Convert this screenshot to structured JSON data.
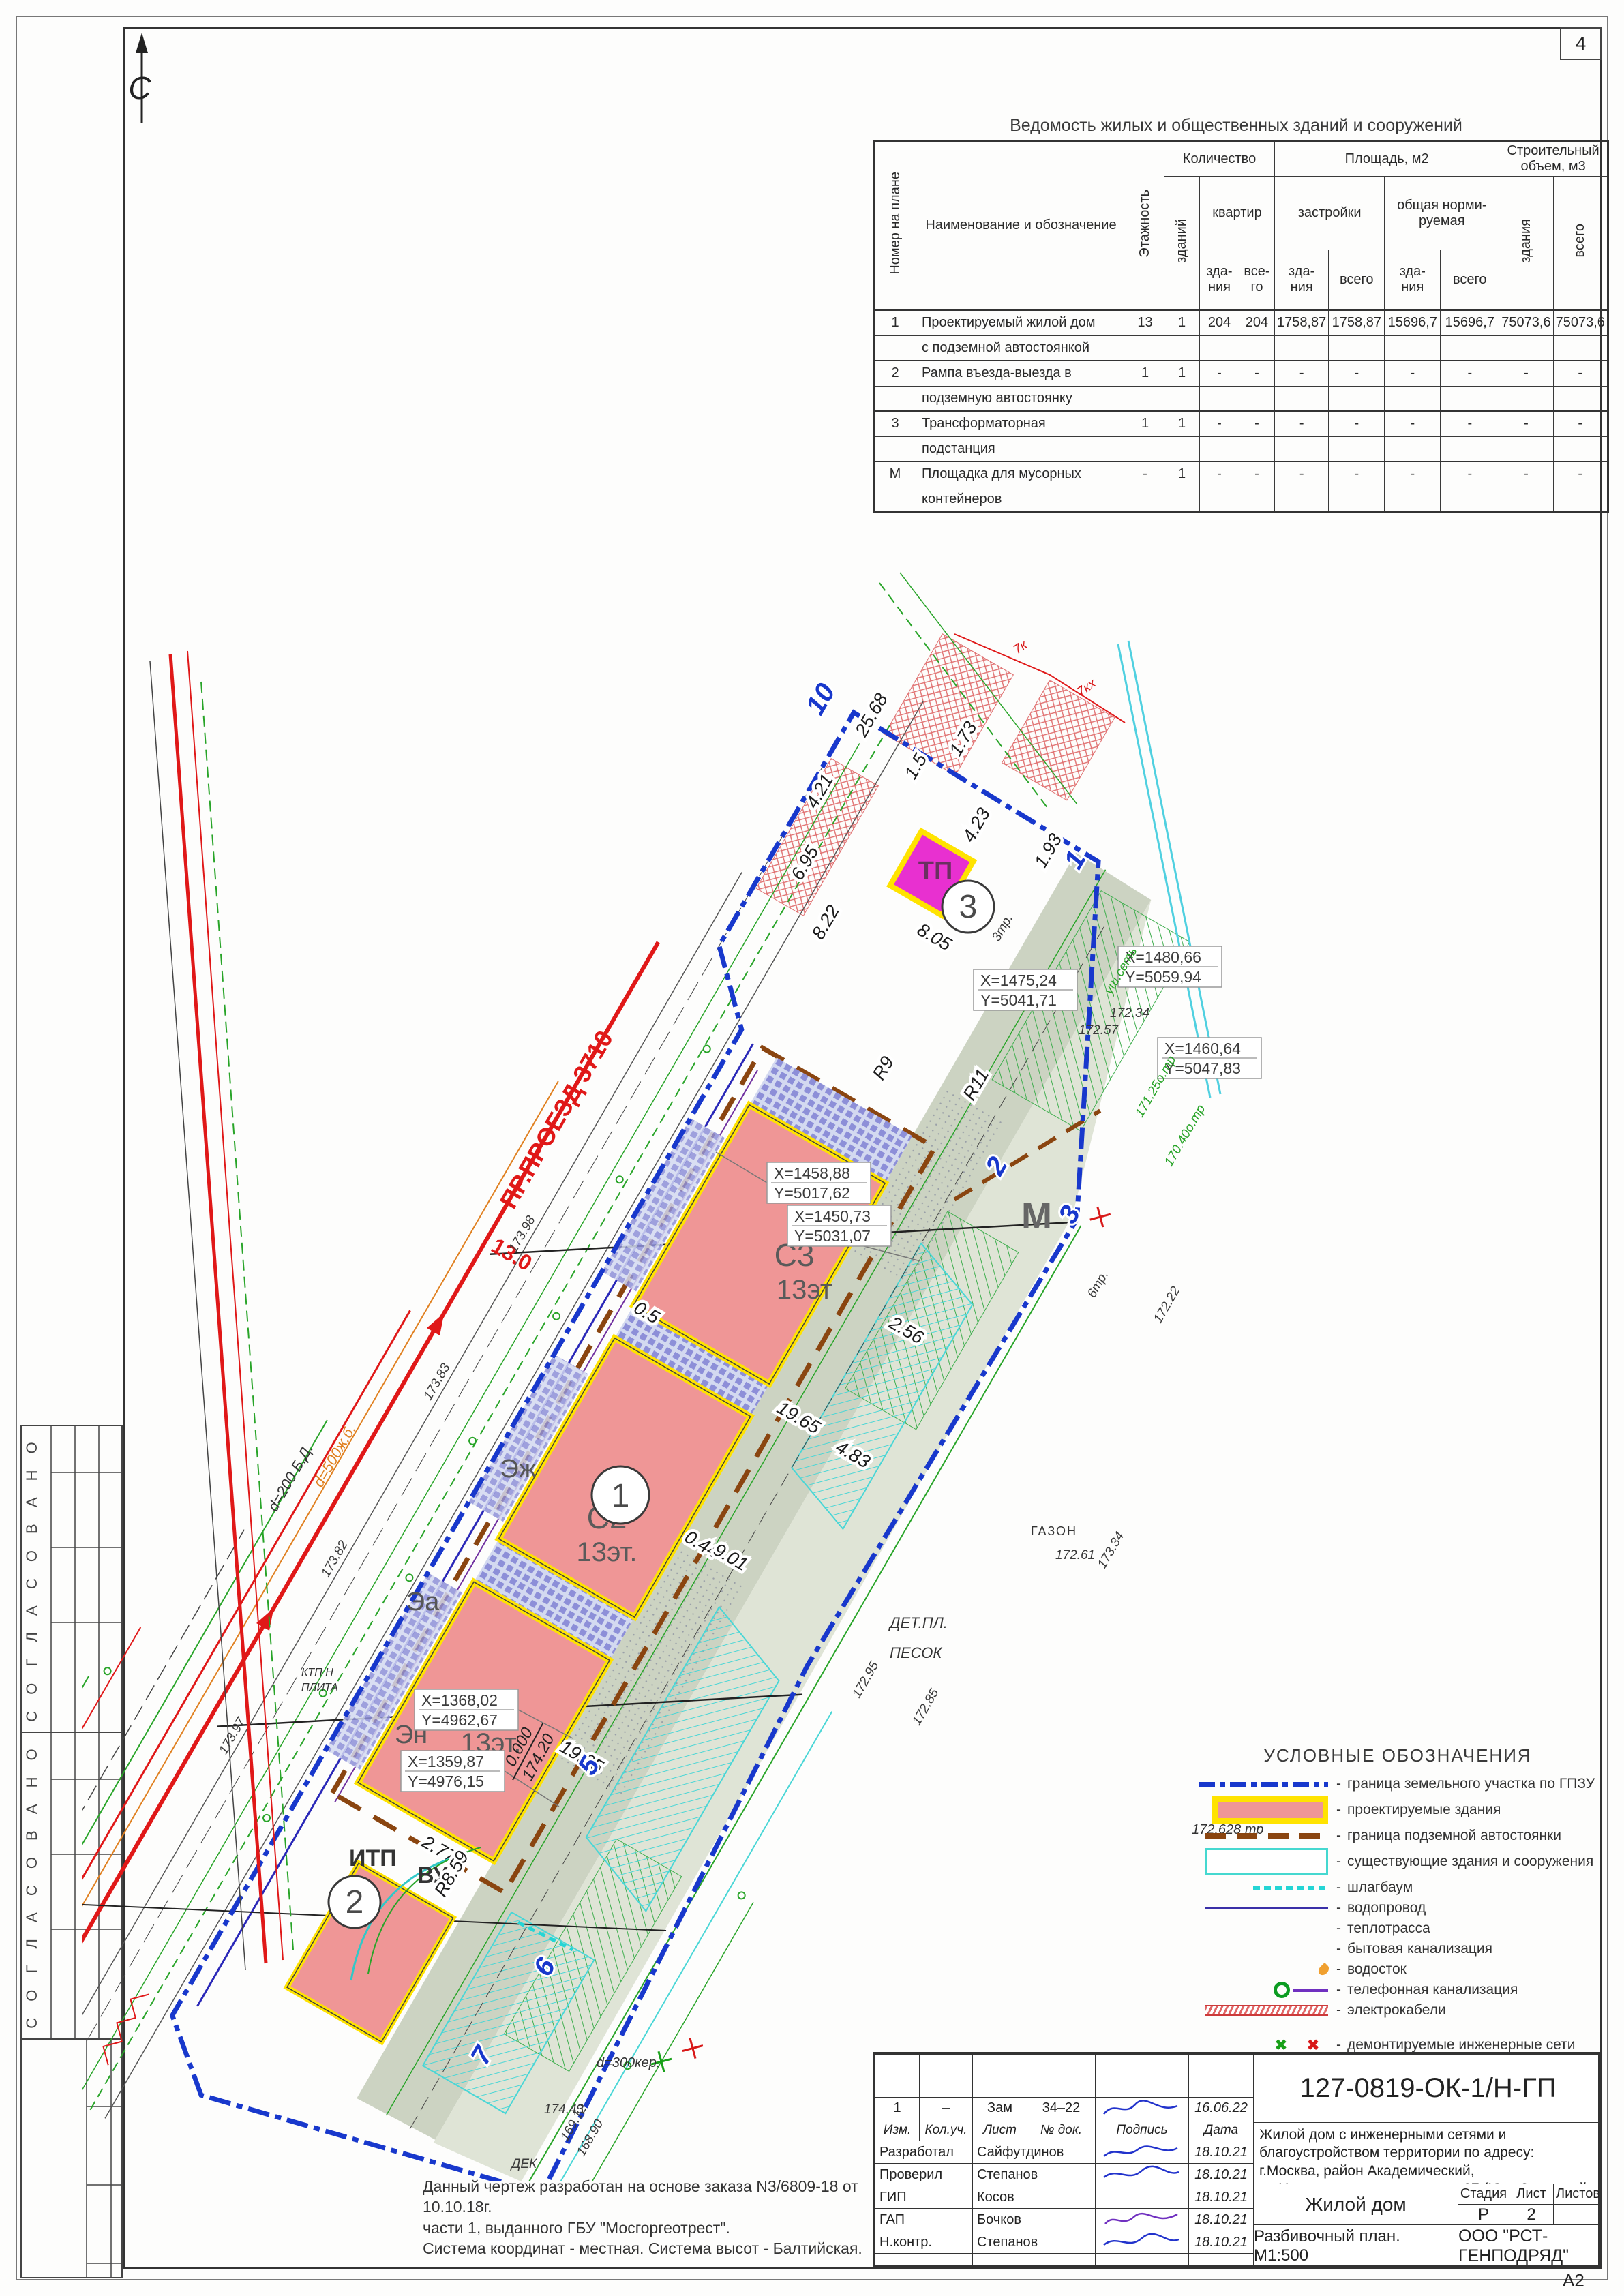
{
  "page": {
    "sheet_number": "4",
    "format": "А2"
  },
  "stamps": {
    "label": "С О Г Л А С О В А Н О"
  },
  "table": {
    "title": "Ведомость жилых и общественных зданий и сооружений",
    "h_num": "Номер на плане",
    "h_name": "Наименование и обозначение",
    "h_floors": "Этажность",
    "h_qty": "Количество",
    "h_qty_bld": "зданий",
    "h_qty_apt": "квартир",
    "h_area": "Площадь, м2",
    "h_built": "застройки",
    "h_norm": "общая норми- руемая",
    "h_bld": "зда- ния",
    "h_vsego_short": "все- го",
    "h_total": "всего",
    "h_vol": "Строительный объем, м3",
    "h_vol_bld": "здания",
    "h_vol_total": "всего",
    "rows": [
      {
        "num": "1",
        "name1": "Проектируемый жилой дом",
        "name2": "с подземной автостоянкой",
        "floors": "13",
        "bld": "1",
        "apt_b": "204",
        "apt_t": "204",
        "built_b": "1758,87",
        "built_t": "1758,87",
        "norm_b": "15696,7",
        "norm_t": "15696,7",
        "vol_b": "75073,6",
        "vol_t": "75073,6"
      },
      {
        "num": "2",
        "name1": "Рампа въезда-выезда в",
        "name2": "подземную автостоянку",
        "floors": "1",
        "bld": "1",
        "apt_b": "-",
        "apt_t": "-",
        "built_b": "-",
        "built_t": "-",
        "norm_b": "-",
        "norm_t": "-",
        "vol_b": "-",
        "vol_t": "-"
      },
      {
        "num": "3",
        "name1": "Трансформаторная",
        "name2": "подстанция",
        "floors": "1",
        "bld": "1",
        "apt_b": "-",
        "apt_t": "-",
        "built_b": "-",
        "built_t": "-",
        "norm_b": "-",
        "norm_t": "-",
        "vol_b": "-",
        "vol_t": "-"
      },
      {
        "num": "М",
        "name1": "Площадка для мусорных",
        "name2": "контейнеров",
        "floors": "-",
        "bld": "1",
        "apt_b": "-",
        "apt_t": "-",
        "built_b": "-",
        "built_t": "-",
        "norm_b": "-",
        "norm_t": "-",
        "vol_b": "-",
        "vol_t": "-"
      }
    ]
  },
  "plan": {
    "north": "С",
    "b1": "1",
    "b2": "2",
    "b3": "3",
    "bld": {
      "c1": "С1",
      "c1f": "13эт.",
      "c2": "С2",
      "c2f": "13эт.",
      "c3": "С3",
      "c3f": "13эт",
      "tp": "ТП",
      "ezh": "Эж",
      "ea": "Эа",
      "en": "Эн",
      "itp": "ИТП",
      "vu": "ВУ",
      "m": "М"
    },
    "pts": {
      "p1": "1",
      "p2": "2",
      "p3": "3",
      "p5": "5",
      "p6": "6",
      "p7": "7",
      "p10": "10"
    },
    "coords": [
      {
        "x": "X=1368,02",
        "y": "Y=4962,67"
      },
      {
        "x": "X=1359,87",
        "y": "Y=4976,15"
      },
      {
        "x": "X=1458,88",
        "y": "Y=5017,62"
      },
      {
        "x": "X=1450,73",
        "y": "Y=5031,07"
      },
      {
        "x": "X=1475,24",
        "y": "Y=5041,71"
      },
      {
        "x": "X=1460,64",
        "y": "Y=5047,83"
      },
      {
        "x": "X=1480,66",
        "y": "Y=5059,94"
      }
    ],
    "dims": [
      "19.65",
      "0.5",
      "0.44",
      "2.56",
      "2.77",
      "4.83",
      "9.01",
      "19.65",
      "8.22",
      "6.95",
      "4.21",
      "25.68",
      "1.5",
      "1.73",
      "4.23",
      "1.93",
      "8.05",
      "R9",
      "R11",
      "R8.59"
    ],
    "road": {
      "name": "ПР.ПРОЕЗД 3710",
      "width": "13.0",
      "pipe1": "d=500ж.б.",
      "pipe2": "d=200 Б.Д."
    },
    "elev": {
      "top": "0.000",
      "bottom": "174.20"
    },
    "texts": {
      "detpl": "ДЕТ.ПЛ.",
      "pesok": "ПЕСОК",
      "gazon": "ГАЗОН",
      "ktp1": "КТП Н",
      "ktp2": "ПЛИТА",
      "pipe3": "d=300кер.",
      "tr": "172.628 тр"
    },
    "spots": [
      "173.97",
      "173.82",
      "173.83",
      "173.98",
      "172.95",
      "172.85",
      "172.22",
      "173.34",
      "171.25о.тр",
      "170.40о.тр",
      "172.57",
      "172.34",
      "172.61",
      "174.43",
      "ДЕК",
      "169.12",
      "168.90",
      "7к",
      "7кх",
      "3тр.",
      "уш.сеть",
      "6тр."
    ]
  },
  "legend": {
    "title": "УСЛОВНЫЕ ОБОЗНАЧЕНИЯ",
    "dash": "-",
    "items": [
      {
        "label": "граница земельного участка по ГПЗУ"
      },
      {
        "label": "проектируемые здания"
      },
      {
        "label": "граница подземной автостоянки"
      },
      {
        "label": "существующие здания и сооружения"
      },
      {
        "label": "шлагбаум"
      },
      {
        "label": "водопровод"
      },
      {
        "label": "теплотрасса"
      },
      {
        "label": "бытовая канализация"
      },
      {
        "label": "водосток"
      },
      {
        "label": "телефонная канализация"
      },
      {
        "label": "электрокабели"
      },
      {
        "label": "демонтируемые инженерные сети"
      }
    ]
  },
  "note": {
    "l1": "Данный чертеж разработан на основе заказа N3/6809-18 от 10.10.18г.",
    "l2": "части 1, выданного ГБУ \"Мосгоргеотрест\".",
    "l3": "Система координат - местная. Система высот - Балтийская."
  },
  "titleblock": {
    "doc_number": "127-0819-ОК-1/Н-ГП",
    "description": "Жилой дом с инженерными сетями и благоустройством территории по адресу: г.Москва, район Академический, ул.Новочеремушкинская, влд. 27 (Юго-Западный административный округ)",
    "rev": {
      "izm": "1",
      "kol": "–",
      "list": "Зам",
      "doc": "34–22",
      "date": "16.06.22"
    },
    "cols": {
      "izm": "Изм.",
      "kol": "Кол.уч.",
      "list": "Лист",
      "doc": "№ док.",
      "sign": "Подпись",
      "date": "Дата"
    },
    "people": [
      {
        "role": "Разработал",
        "name": "Сайфутдинов",
        "date": "18.10.21"
      },
      {
        "role": "Проверил",
        "name": "Степанов",
        "date": "18.10.21"
      },
      {
        "role": "ГИП",
        "name": "Косов",
        "date": "18.10.21"
      },
      {
        "role": "ГАП",
        "name": "Бочков",
        "date": "18.10.21"
      },
      {
        "role": "Н.контр.",
        "name": "Степанов",
        "date": "18.10.21"
      }
    ],
    "stage_h": "Стадия",
    "sheet_h": "Лист",
    "sheets_h": "Листов",
    "stage": "Р",
    "sheet": "2",
    "sheets": "",
    "object": "Жилой дом",
    "drawing": "Разбивочный план. М1:500",
    "company": "ООО \"РСТ-ГЕНПОДРЯД\""
  }
}
